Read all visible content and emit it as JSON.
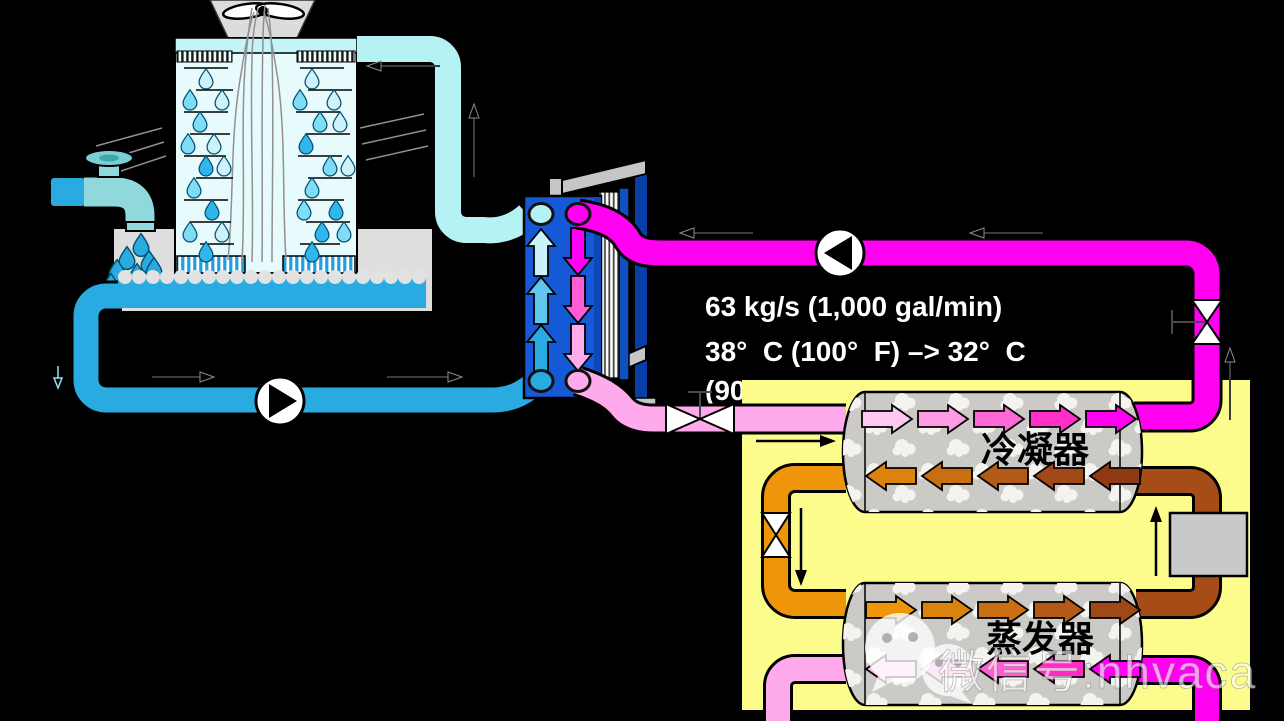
{
  "texts": {
    "flow_rate": "63 kg/s (1,000 gal/min)",
    "temp_line": "38°  C (100°  F) –> 32°  C",
    "temp_line2": "(90°  F)",
    "condenser_label": "冷凝器",
    "evaporator_label": "蒸发器",
    "watermark": "微信号:nhvaca"
  },
  "colors": {
    "background": "#000000",
    "chiller_panel": "#FCFC8C",
    "tower_fill": "#E7FBFD",
    "basin_water": "#29ABE2",
    "tower_supply_pipe": "#B5F2F4",
    "tower_return_pipe": "#29ABE2",
    "condenser_water_hot": "#FF00F0",
    "condenser_water_cool": "#FFAAEC",
    "refrigerant_liquid_orange": "#EE950A",
    "refrigerant_vapor_brown": "#A64C16",
    "vessel_shell_gray": "#CBCAC6",
    "heat_exchanger_blue": "#1659D6",
    "faucet_teal": "#8FD9DC"
  },
  "icons": {
    "fan": "fan-icon",
    "faucet": "faucet-icon",
    "pump": "pump-icon",
    "valve": "valve-icon",
    "expansion_valve": "expansion-valve-icon",
    "compressor": "compressor-box",
    "wechat": "wechat-icon"
  }
}
